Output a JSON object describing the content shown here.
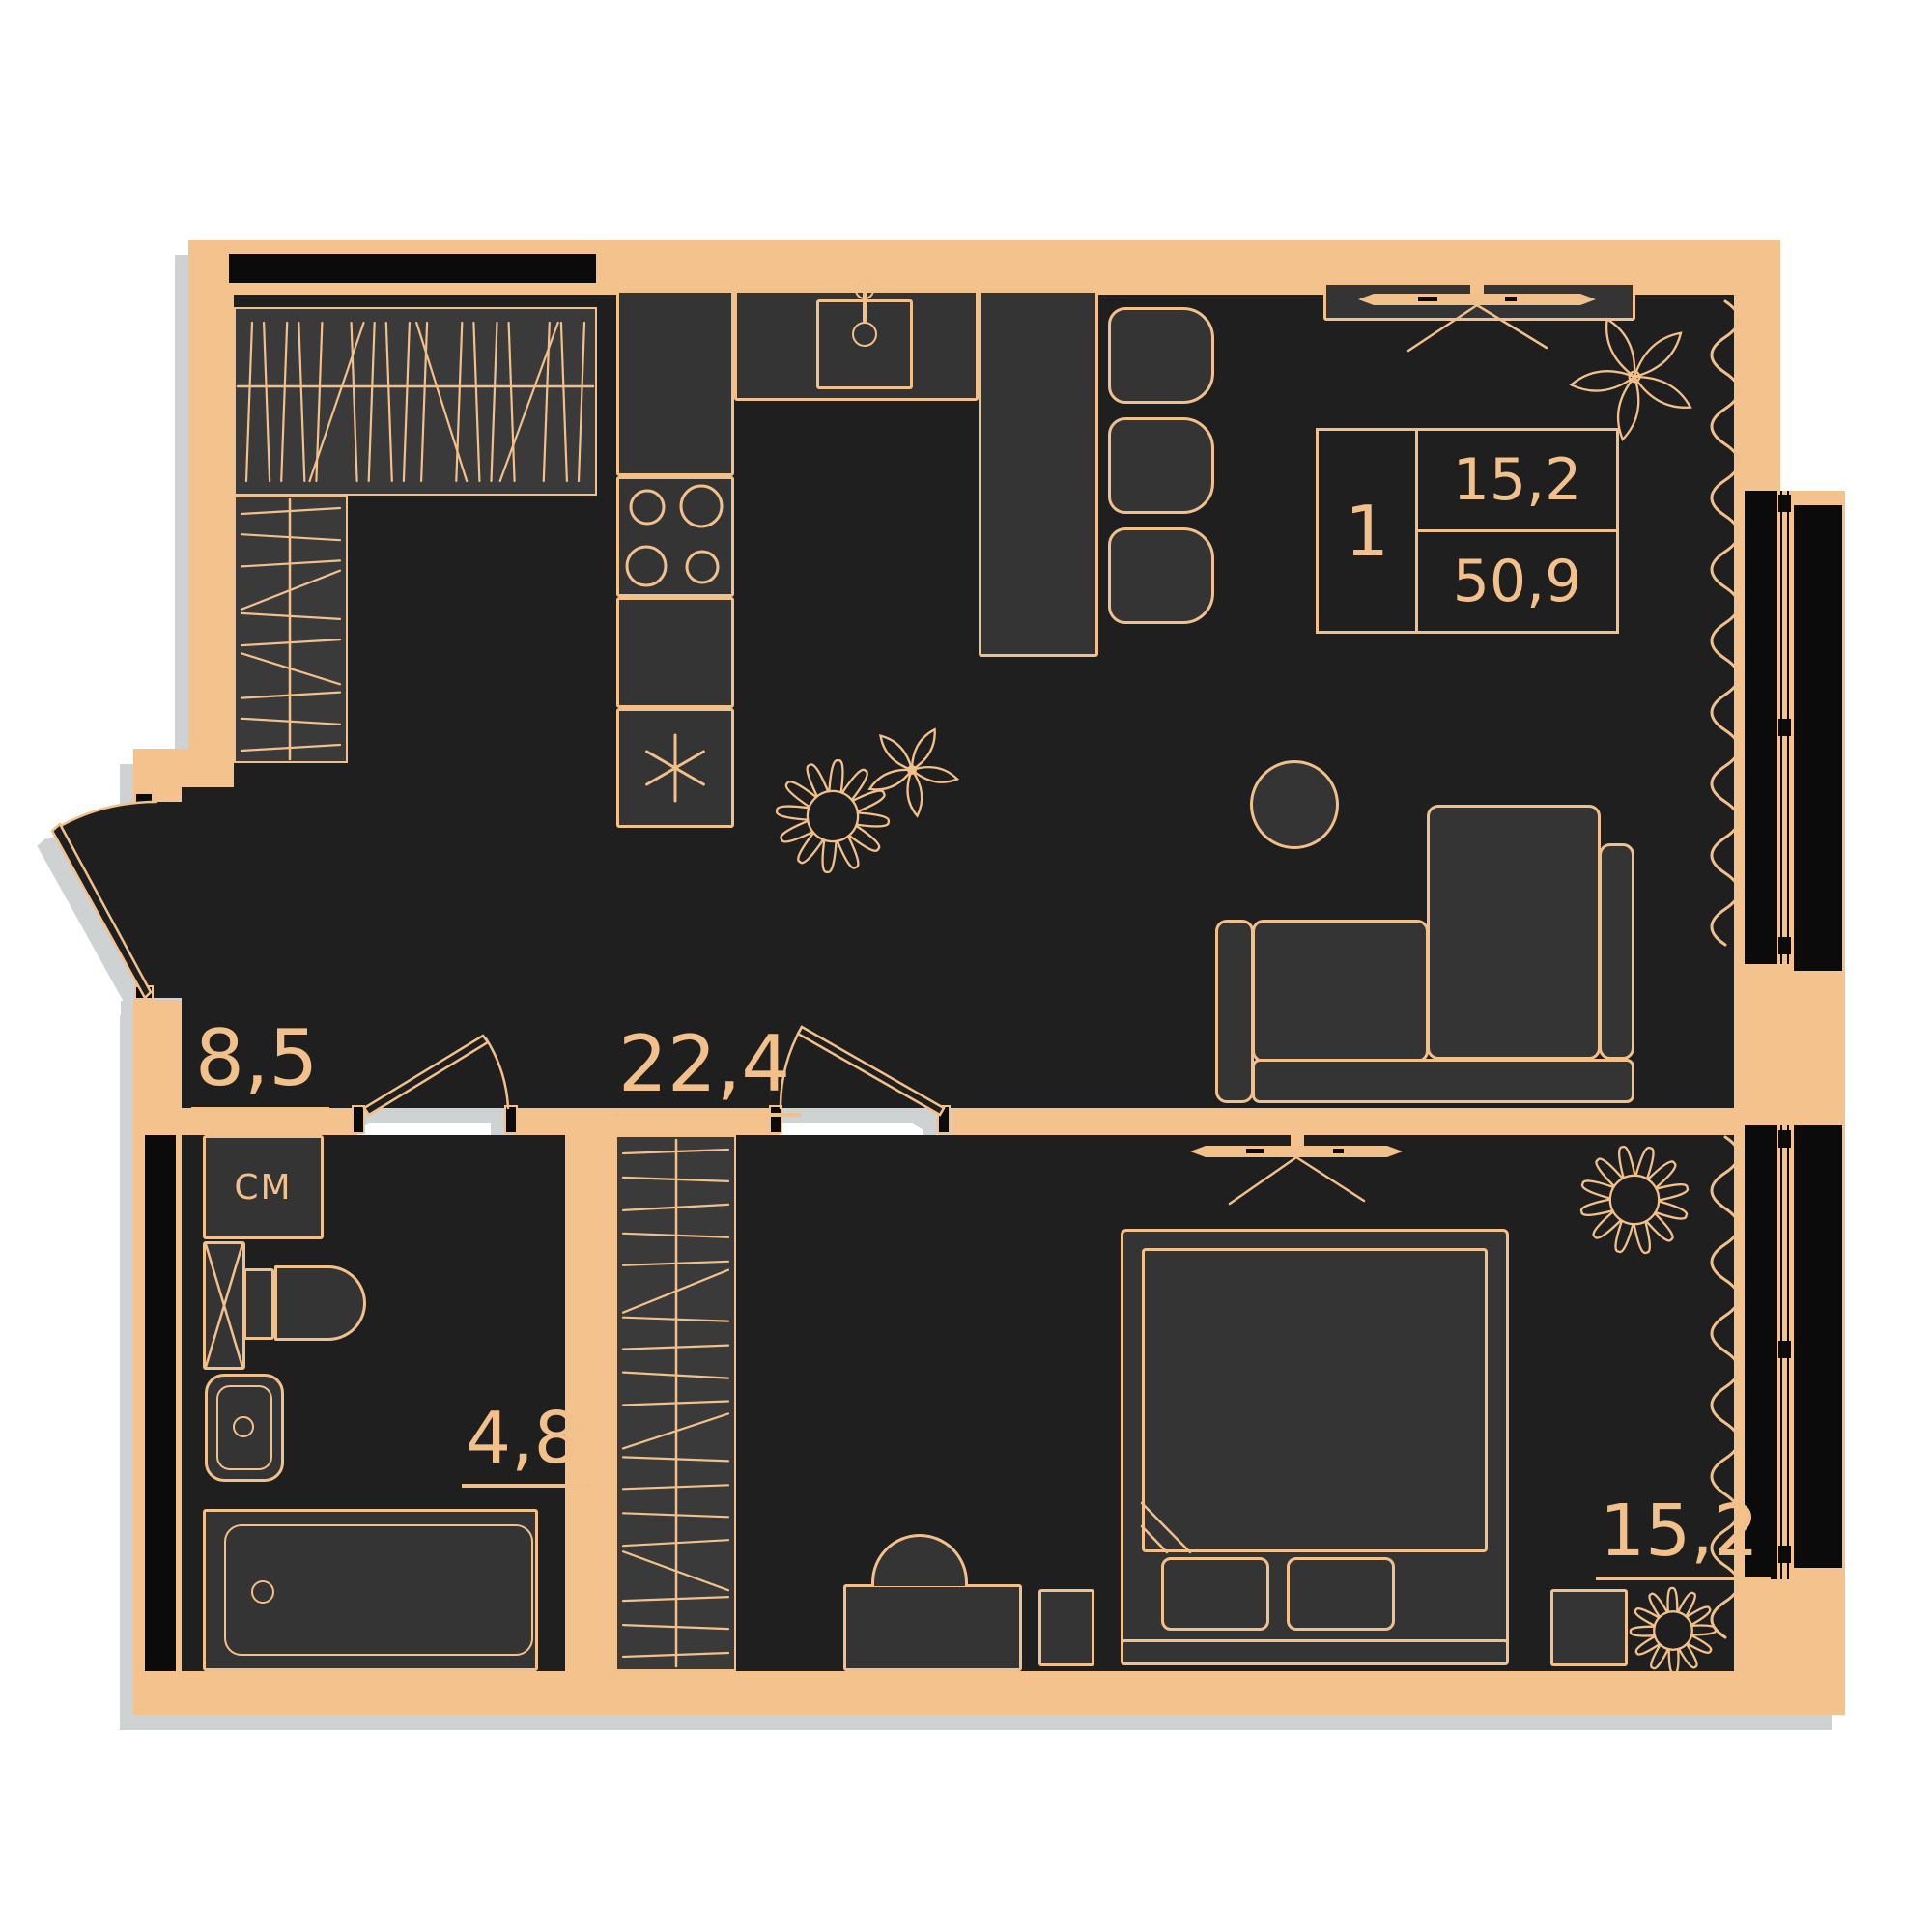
{
  "plan_title": "1-room apartment floor plan",
  "info_box": {
    "rooms_count": "1",
    "living_area": "15,2",
    "total_area": "50,9"
  },
  "rooms": {
    "hallway": {
      "area": "8,5"
    },
    "kitchen_living": {
      "area": "22,4"
    },
    "bathroom": {
      "area": "4,8"
    },
    "bedroom": {
      "area": "15,2"
    }
  },
  "appliances": {
    "washing_machine": "СМ"
  },
  "icons": {
    "kitchen": [
      "stove-burners-icon",
      "kitchen-sink-icon",
      "kitchen-faucet-icon",
      "fridge-snowflake-icon",
      "bar-chair"
    ],
    "living_room": [
      "sofa",
      "side-table",
      "tv-icon",
      "curtain-wave-icon",
      "plant-flower-icon",
      "bar-counter"
    ],
    "bedroom": [
      "bed",
      "pillow",
      "nightstand",
      "desk",
      "desk-chair",
      "tv-icon",
      "wardrobe-hatch",
      "curtain-wave-icon",
      "plant-flower-icon"
    ],
    "bathroom": [
      "washing-machine",
      "toilet",
      "bathroom-sink",
      "bathtub",
      "duct-x-icon"
    ],
    "hallway": [
      "wardrobe-hatch",
      "door-swing-icon"
    ],
    "windows": [
      "window-glazing",
      "balcony-panel"
    ]
  },
  "colors": {
    "wall": "#F4C28C",
    "line": "#F2C08A",
    "floor": "#1F1F1F",
    "furniture": "#343434",
    "furniture_light": "#3A3A3A",
    "black": "#0B0B0B",
    "page": "#FFFFFF",
    "shadow": "#CFD2D2"
  }
}
